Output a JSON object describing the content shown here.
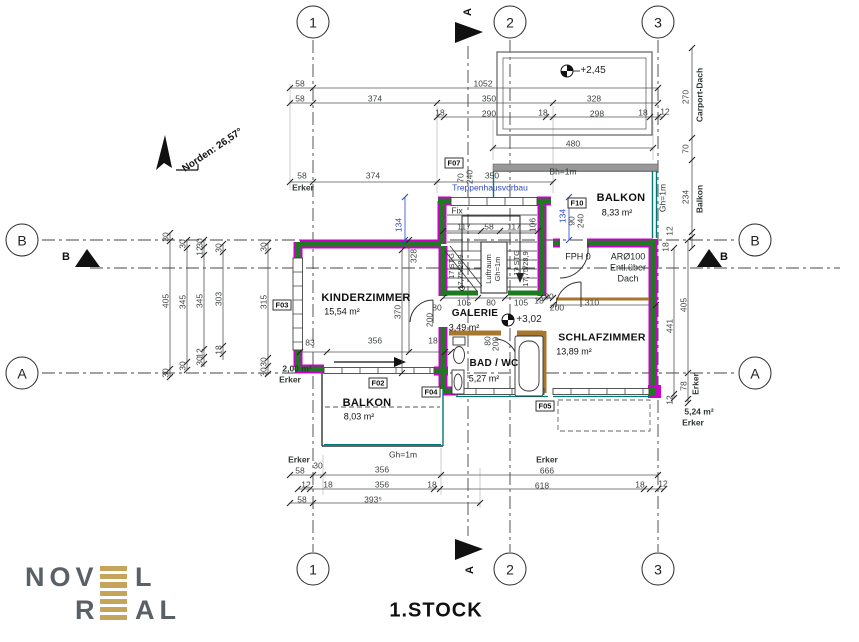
{
  "plan": {
    "title": "1.STOCK",
    "north": "Norden: 26,57°"
  },
  "axes": {
    "top": [
      "1",
      "2",
      "3"
    ],
    "bottom": [
      "1",
      "2",
      "3"
    ],
    "left": [
      "B",
      "A"
    ],
    "right": [
      "B",
      "A"
    ]
  },
  "sections": {
    "top": "A",
    "bottom": "A",
    "left": "B",
    "right": "B"
  },
  "rooms": {
    "kinderzimmer": {
      "name": "KINDERZIMMER",
      "area": "15,54 m²"
    },
    "galerie": {
      "name": "GALERIE",
      "area": "3,49 m²"
    },
    "bad": {
      "name": "BAD / WC",
      "area": "5,27 m²"
    },
    "schlafzimmer": {
      "name": "SCHLAFZIMMER",
      "area": "13,89 m²"
    },
    "balkon_nord": {
      "name": "BALKON",
      "area": "8,33 m²"
    },
    "balkon_sued": {
      "name": "BALKON",
      "area": "8,03 m²"
    },
    "erker_west": {
      "name": "Erker",
      "area": "2,00 m²"
    },
    "erker_ost": {
      "name": "Erker",
      "area": "5,24 m²"
    }
  },
  "elevations": {
    "carport": "+2,45",
    "galerie": "+3,02"
  },
  "tags": {
    "f02": "F02",
    "f03": "F03",
    "f04": "F04",
    "f05": "F05",
    "f07": "F07",
    "f10": "F10"
  },
  "notes": {
    "treppenhausvorbau": "Treppenhausvorbau",
    "bh": "Bh=1m",
    "gh_nord": "Gh=1m",
    "gh_sued": "Gh=1m",
    "fix": "Fix",
    "fph": "FPH 0",
    "ar": "ARØ100",
    "ar2": "Entl.über",
    "ar3": "Dach",
    "stg": "17 STG",
    "stg_detail": "17,75/28,9",
    "luftraum": "Luftraum",
    "luftraum_gh": "Gh=1m"
  },
  "logo": {
    "l1a": "NOV",
    "l1b": "L",
    "l2a": "R",
    "l2b": "AL"
  },
  "colors": {
    "wall_new_magenta": "#cc00cc",
    "wall_green": "#1e7a1e",
    "teal": "#007878",
    "wood_brown": "#a8762e",
    "dim_blue": "#2b47c4",
    "logo_gold": "#c7a45b",
    "logo_gray": "#5a6068"
  },
  "dims": [
    {
      "t": "58",
      "x": 300,
      "y": 84
    },
    {
      "t": "1052",
      "x": 483,
      "y": 84
    },
    {
      "t": "58",
      "x": 300,
      "y": 99
    },
    {
      "t": "374",
      "x": 375,
      "y": 99
    },
    {
      "t": "350",
      "x": 489,
      "y": 99
    },
    {
      "t": "328",
      "x": 594,
      "y": 99
    },
    {
      "t": "18",
      "x": 440,
      "y": 113
    },
    {
      "t": "290",
      "x": 489,
      "y": 114
    },
    {
      "t": "18",
      "x": 543,
      "y": 113
    },
    {
      "t": "298",
      "x": 597,
      "y": 114
    },
    {
      "t": "18",
      "x": 643,
      "y": 113
    },
    {
      "t": "12",
      "x": 665,
      "y": 112
    },
    {
      "t": "480",
      "x": 573,
      "y": 144
    },
    {
      "t": "58",
      "x": 302,
      "y": 176
    },
    {
      "t": "374",
      "x": 373,
      "y": 176
    },
    {
      "t": "350",
      "x": 492,
      "y": 176
    },
    {
      "t": "Erker",
      "x": 303,
      "y": 188,
      "c": "lab"
    },
    {
      "t": "270",
      "x": 686,
      "y": 97,
      "r": -90
    },
    {
      "t": "Carport-Dach",
      "x": 700,
      "y": 95,
      "r": -90,
      "c": "lab"
    },
    {
      "t": "70",
      "x": 686,
      "y": 149,
      "r": -90
    },
    {
      "t": "234",
      "x": 686,
      "y": 197,
      "r": -90
    },
    {
      "t": "Balkon",
      "x": 700,
      "y": 199,
      "r": -90,
      "c": "lab"
    },
    {
      "t": "12",
      "x": 670,
      "y": 231,
      "r": -90
    },
    {
      "t": "18",
      "x": 666,
      "y": 247,
      "r": -90
    },
    {
      "t": "441",
      "x": 670,
      "y": 326,
      "r": -90
    },
    {
      "t": "405",
      "x": 684,
      "y": 305,
      "r": -90
    },
    {
      "t": "78",
      "x": 684,
      "y": 386,
      "r": -90
    },
    {
      "t": "Erker",
      "x": 696,
      "y": 384,
      "r": -90,
      "c": "lab"
    },
    {
      "t": "12",
      "x": 670,
      "y": 400,
      "r": -90
    },
    {
      "t": "30",
      "x": 166,
      "y": 237,
      "r": -90
    },
    {
      "t": "405",
      "x": 166,
      "y": 301,
      "r": -90
    },
    {
      "t": "30",
      "x": 166,
      "y": 373,
      "r": -90
    },
    {
      "t": "30",
      "x": 183,
      "y": 244,
      "r": -90
    },
    {
      "t": "345",
      "x": 183,
      "y": 302,
      "r": -90
    },
    {
      "t": "30",
      "x": 183,
      "y": 366,
      "r": -90
    },
    {
      "t": "30",
      "x": 200,
      "y": 243,
      "r": -90
    },
    {
      "t": "12",
      "x": 200,
      "y": 251,
      "r": -90
    },
    {
      "t": "345",
      "x": 200,
      "y": 301,
      "r": -90
    },
    {
      "t": "12",
      "x": 200,
      "y": 353,
      "r": -90
    },
    {
      "t": "30",
      "x": 200,
      "y": 361,
      "r": -90
    },
    {
      "t": "30",
      "x": 219,
      "y": 248,
      "r": -90
    },
    {
      "t": "303",
      "x": 219,
      "y": 299,
      "r": -90
    },
    {
      "t": "18",
      "x": 219,
      "y": 350,
      "r": -90
    },
    {
      "t": "30",
      "x": 264,
      "y": 247,
      "r": -90
    },
    {
      "t": "315",
      "x": 264,
      "y": 302,
      "r": -90
    },
    {
      "t": "30",
      "x": 264,
      "y": 362,
      "r": -90
    },
    {
      "t": "30",
      "x": 264,
      "y": 372,
      "r": -90
    },
    {
      "t": "83",
      "x": 310,
      "y": 343
    },
    {
      "t": "356",
      "x": 375,
      "y": 341
    },
    {
      "t": "18",
      "x": 433,
      "y": 341
    },
    {
      "t": "328",
      "x": 414,
      "y": 256,
      "r": -90
    },
    {
      "t": "370",
      "x": 398,
      "y": 312,
      "r": -90
    },
    {
      "t": "80",
      "x": 437,
      "y": 308
    },
    {
      "t": "200",
      "x": 430,
      "y": 320,
      "r": -90
    },
    {
      "t": "134",
      "x": 399,
      "y": 225,
      "r": -90,
      "c": "b"
    },
    {
      "t": "134",
      "x": 563,
      "y": 216,
      "r": -90,
      "c": "b"
    },
    {
      "t": "70",
      "x": 461,
      "y": 178,
      "r": -90
    },
    {
      "t": "240",
      "x": 470,
      "y": 177,
      "r": -90
    },
    {
      "t": "90",
      "x": 572,
      "y": 221,
      "r": -90
    },
    {
      "t": "240",
      "x": 581,
      "y": 221,
      "r": -90
    },
    {
      "t": "117",
      "x": 464,
      "y": 227
    },
    {
      "t": "58",
      "x": 489,
      "y": 227
    },
    {
      "t": "117",
      "x": 514,
      "y": 227
    },
    {
      "t": "106",
      "x": 533,
      "y": 225,
      "r": -90
    },
    {
      "t": "105",
      "x": 464,
      "y": 303
    },
    {
      "t": "80",
      "x": 491,
      "y": 303
    },
    {
      "t": "105",
      "x": 521,
      "y": 303
    },
    {
      "t": "18",
      "x": 539,
      "y": 301
    },
    {
      "t": "80",
      "x": 549,
      "y": 297
    },
    {
      "t": "200",
      "x": 557,
      "y": 308
    },
    {
      "t": "310",
      "x": 592,
      "y": 303
    },
    {
      "t": "80",
      "x": 488,
      "y": 341,
      "r": -90
    },
    {
      "t": "200",
      "x": 496,
      "y": 344,
      "r": -90
    },
    {
      "t": "Erker",
      "x": 299,
      "y": 460,
      "c": "lab"
    },
    {
      "t": "58",
      "x": 300,
      "y": 471
    },
    {
      "t": "30",
      "x": 318,
      "y": 466
    },
    {
      "t": "356",
      "x": 382,
      "y": 470
    },
    {
      "t": "Erker",
      "x": 547,
      "y": 460,
      "c": "lab"
    },
    {
      "t": "666",
      "x": 547,
      "y": 471
    },
    {
      "t": "12",
      "x": 306,
      "y": 485
    },
    {
      "t": "18",
      "x": 328,
      "y": 485
    },
    {
      "t": "356",
      "x": 382,
      "y": 485
    },
    {
      "t": "18",
      "x": 432,
      "y": 485
    },
    {
      "t": "618",
      "x": 542,
      "y": 486
    },
    {
      "t": "18",
      "x": 640,
      "y": 485
    },
    {
      "t": "12",
      "x": 663,
      "y": 484
    },
    {
      "t": "58",
      "x": 302,
      "y": 500
    },
    {
      "t": "393⁵",
      "x": 373,
      "y": 500
    }
  ]
}
